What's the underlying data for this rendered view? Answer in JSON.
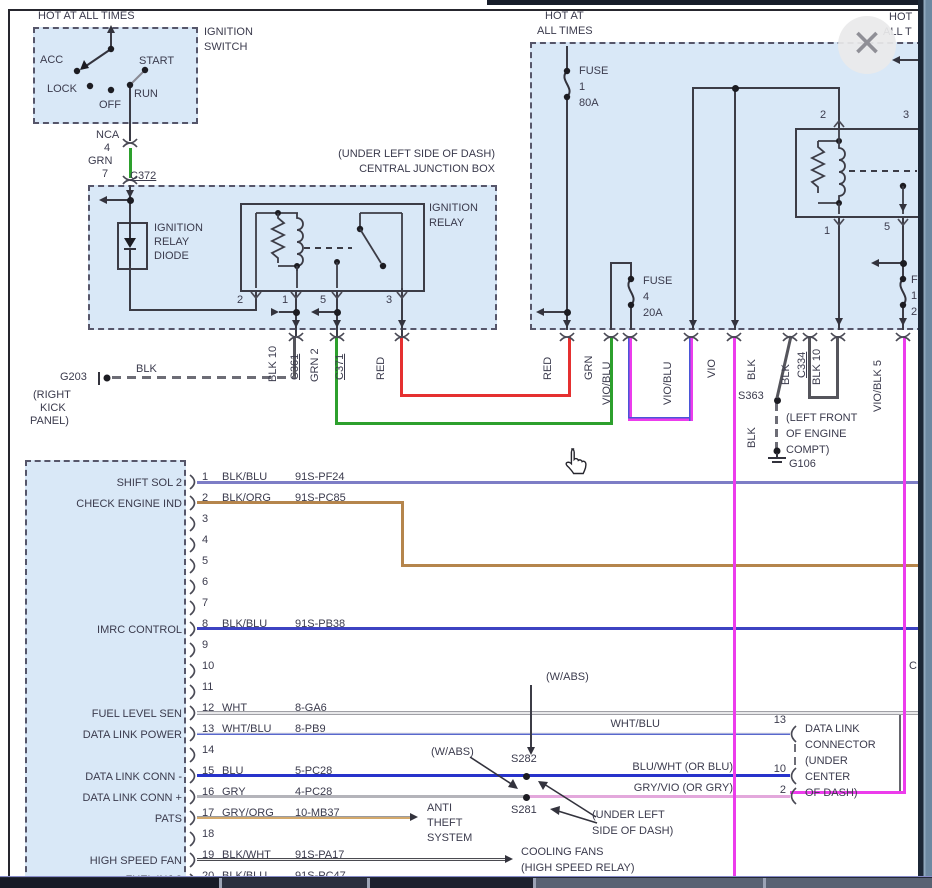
{
  "window": {
    "close_glyph": "✕"
  },
  "ignition_switch": {
    "hot": "HOT AT ALL TIMES",
    "name1": "IGNITION",
    "name2": "SWITCH",
    "positions": {
      "acc": "ACC",
      "lock": "LOCK",
      "off": "OFF",
      "run": "RUN",
      "start": "START"
    }
  },
  "c372": {
    "nca": "NCA",
    "n4": "4",
    "grn": "GRN",
    "n7": "7",
    "conn": "C372"
  },
  "cjb": {
    "loc": "(UNDER LEFT SIDE OF DASH)",
    "name": "CENTRAL JUNCTION BOX",
    "relay1": "IGNITION",
    "relay2": "RELAY",
    "diode1": "IGNITION",
    "diode2": "RELAY",
    "diode3": "DIODE",
    "p2": "2",
    "p1": "1",
    "p5": "5",
    "p3": "3",
    "blk10": "BLK 10",
    "c361": "C361",
    "grn2": "GRN 2",
    "c371": "C371",
    "red": "RED"
  },
  "g203": {
    "name": "G203",
    "loc1": "(RIGHT",
    "loc2": "KICK",
    "loc3": "PANEL)",
    "wire": "BLK"
  },
  "right_box": {
    "hot1a": "HOT AT",
    "hot1b": "ALL TIMES",
    "hot2a": "HOT",
    "hot2b": "ALL T",
    "fuse1": [
      "FUSE",
      "1",
      "80A"
    ],
    "fuse4": [
      "FUSE",
      "4",
      "20A"
    ],
    "fuse_cut": [
      "F",
      "1",
      "2"
    ],
    "p2": "2",
    "p3": "3",
    "p1": "1",
    "p5": "5",
    "wires": {
      "red": "RED",
      "grn": "GRN",
      "vioblu_a": "VIO/BLU",
      "vioblu_b": "VIO/BLU",
      "vio": "VIO",
      "blk_a": "BLK",
      "blk_b": "BLK",
      "c334": "C334",
      "blk10": "BLK 10",
      "vioblk": "VIO/BLK 5"
    }
  },
  "s363": {
    "name": "S363",
    "wire": "BLK",
    "ground": "G106",
    "loc1": "(LEFT FRONT",
    "loc2": "OF ENGINE",
    "loc3": "COMPT)"
  },
  "pcm": {
    "rows": [
      {
        "n": "1",
        "wire": "BLK/BLU",
        "code": "91S-PF24",
        "left": "SHIFT SOL 2"
      },
      {
        "n": "2",
        "wire": "BLK/ORG",
        "code": "91S-PC85",
        "left": "CHECK ENGINE IND"
      },
      {
        "n": "3",
        "wire": "",
        "code": "",
        "left": ""
      },
      {
        "n": "4",
        "wire": "",
        "code": "",
        "left": ""
      },
      {
        "n": "5",
        "wire": "",
        "code": "",
        "left": ""
      },
      {
        "n": "6",
        "wire": "",
        "code": "",
        "left": ""
      },
      {
        "n": "7",
        "wire": "",
        "code": "",
        "left": ""
      },
      {
        "n": "8",
        "wire": "BLK/BLU",
        "code": "91S-PB38",
        "left": "IMRC CONTROL"
      },
      {
        "n": "9",
        "wire": "",
        "code": "",
        "left": ""
      },
      {
        "n": "10",
        "wire": "",
        "code": "",
        "left": ""
      },
      {
        "n": "11",
        "wire": "",
        "code": "",
        "left": ""
      },
      {
        "n": "12",
        "wire": "WHT",
        "code": "8-GA6",
        "left": "FUEL LEVEL SEN"
      },
      {
        "n": "13",
        "wire": "WHT/BLU",
        "code": "8-PB9",
        "left": "DATA LINK POWER"
      },
      {
        "n": "14",
        "wire": "",
        "code": "",
        "left": ""
      },
      {
        "n": "15",
        "wire": "BLU",
        "code": "5-PC28",
        "left": "DATA LINK CONN -"
      },
      {
        "n": "16",
        "wire": "GRY",
        "code": "4-PC28",
        "left": "DATA LINK CONN +"
      },
      {
        "n": "17",
        "wire": "GRY/ORG",
        "code": "10-MB37",
        "left": "PATS"
      },
      {
        "n": "18",
        "wire": "",
        "code": "",
        "left": ""
      },
      {
        "n": "19",
        "wire": "BLK/WHT",
        "code": "91S-PA17",
        "left": "HIGH SPEED FAN"
      },
      {
        "n": "20",
        "wire": "BLK/BLU",
        "code": "91S-PC47",
        "left": "FUEL INJ 3"
      }
    ]
  },
  "middle": {
    "wabs1": "(W/ABS)",
    "wabs2": "(W/ABS)",
    "s282": "S282",
    "s281": "S281",
    "under1": "(UNDER LEFT",
    "under2": "SIDE OF DASH)",
    "whtblu": "WHT/BLU",
    "bluwht": "BLU/WHT (OR BLU)",
    "gryvio": "GRY/VIO (OR GRY)",
    "anti1": "ANTI",
    "anti2": "THEFT",
    "anti3": "SYSTEM",
    "cool1": "COOLING FANS",
    "cool2": "(HIGH SPEED RELAY)"
  },
  "dlc": {
    "p13": "13",
    "p10": "10",
    "p2": "2",
    "l1": "DATA LINK",
    "l2": "CONNECTOR",
    "l3": "(UNDER",
    "l4": "CENTER",
    "l5": "OF DASH)",
    "cut": "C"
  },
  "colors": {
    "panel_blue": "#d9e8f7",
    "green": "#2da02d",
    "red": "#e53030",
    "violet": "#ec3cec",
    "blue": "#2733cb",
    "blk_blu": "#7d7dc6",
    "blk_org": "#b5854c",
    "imrc_blue": "#3d43c2",
    "gry_vio": "#e3a8dc",
    "text": "#3b3b4d"
  }
}
